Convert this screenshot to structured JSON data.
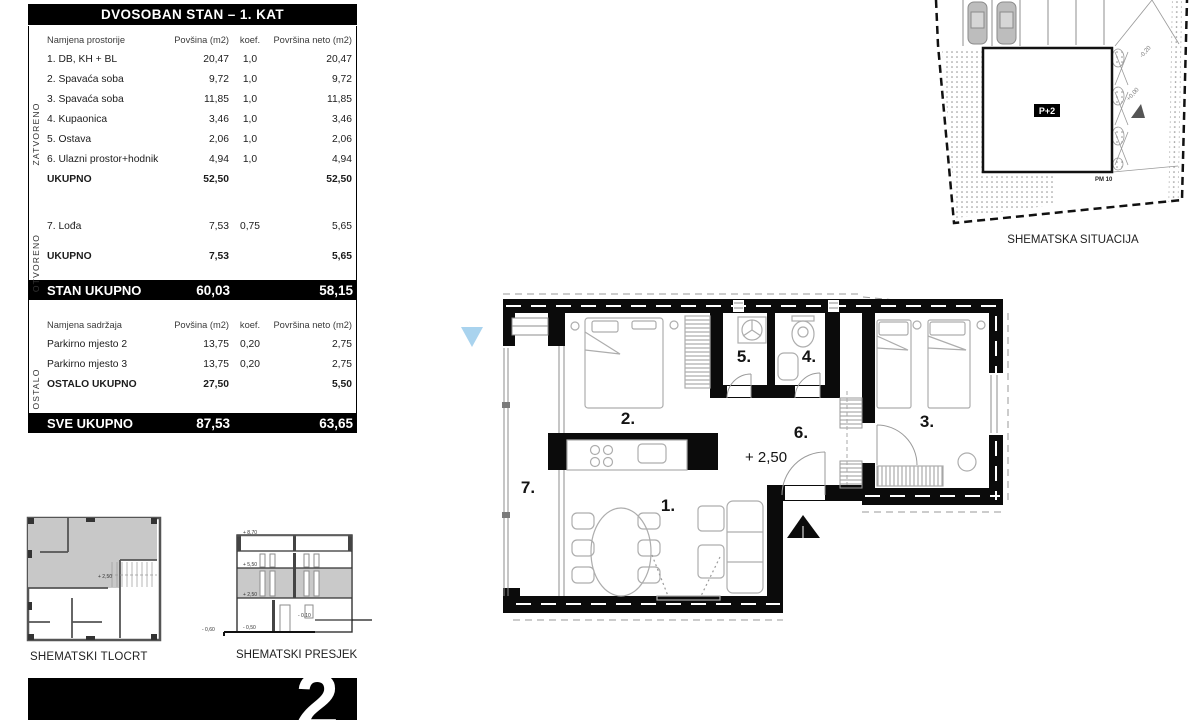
{
  "summary_table": {
    "title": "DVOSOBAN STAN – 1. KAT",
    "columns": {
      "name": "Namjena prostorije",
      "area": "Povšina (m2)",
      "koef": "koef.",
      "neto": "Površina neto (m2)"
    },
    "columns2": {
      "name": "Namjena sadržaja",
      "area": "Povšina (m2)",
      "koef": "koef.",
      "neto": "Površina neto (m2)"
    },
    "zatvoreno": {
      "label": "ZATVORENO",
      "rows": [
        {
          "name": "1. DB, KH + BL",
          "area": "20,47",
          "koef": "1,0",
          "neto": "20,47"
        },
        {
          "name": "2. Spavaća soba",
          "area": "9,72",
          "koef": "1,0",
          "neto": "9,72"
        },
        {
          "name": "3. Spavaća soba",
          "area": "11,85",
          "koef": "1,0",
          "neto": "11,85"
        },
        {
          "name": "4. Kupaonica",
          "area": "3,46",
          "koef": "1,0",
          "neto": "3,46"
        },
        {
          "name": "5. Ostava",
          "area": "2,06",
          "koef": "1,0",
          "neto": "2,06"
        },
        {
          "name": "6. Ulazni prostor+hodnik",
          "area": "4,94",
          "koef": "1,0",
          "neto": "4,94"
        }
      ],
      "total": {
        "name": "UKUPNO",
        "area": "52,50",
        "neto": "52,50"
      }
    },
    "otvoreno": {
      "label": "OTVORENO",
      "rows": [
        {
          "name": "7. Lođa",
          "area": "7,53",
          "koef": "0,75",
          "neto": "5,65"
        }
      ],
      "total": {
        "name": "UKUPNO",
        "area": "7,53",
        "neto": "5,65"
      }
    },
    "stan_total": {
      "label": "STAN UKUPNO",
      "area": "60,03",
      "neto": "58,15"
    },
    "ostalo": {
      "label": "OSTALO",
      "rows": [
        {
          "name": "Parkirno mjesto 2",
          "area": "13,75",
          "koef": "0,20",
          "neto": "2,75"
        },
        {
          "name": "Parkirno mjesto 3",
          "area": "13,75",
          "koef": "0,20",
          "neto": "2,75"
        }
      ],
      "total": {
        "name": "OSTALO UKUPNO",
        "area": "27,50",
        "neto": "5,50"
      }
    },
    "sve_total": {
      "label": "SVE UKUPNO",
      "area": "87,53",
      "neto": "63,65"
    }
  },
  "floor_plan": {
    "rooms": {
      "r1": "1.",
      "r2": "2.",
      "r3": "3.",
      "r4": "4.",
      "r5": "5.",
      "r6": "6.",
      "r7": "7."
    },
    "level": "+ 2,50"
  },
  "site_plan": {
    "caption": "SHEMATSKA SITUACIJA",
    "building": "P+2",
    "parking": "PM 10",
    "level_zero": "+0,00",
    "level_minus": "-0,20"
  },
  "tlocrt": {
    "caption": "SHEMATSKI TLOCRT",
    "level": "+ 2,50"
  },
  "presjek": {
    "caption": "SHEMATSKI PRESJEK",
    "levels": {
      "roof": "+ 8,70",
      "f2": "+ 5,50",
      "f1": "+ 2,50",
      "ground": "- 0,50",
      "annex": "- 0,10",
      "terrain": "- 0,60"
    }
  },
  "badge": {
    "number": "2"
  },
  "colors": {
    "accent_blue": "#a9d3ee",
    "wall": "#0b0b0b",
    "furniture": "#adadad",
    "shade": "#c9c9c9"
  }
}
